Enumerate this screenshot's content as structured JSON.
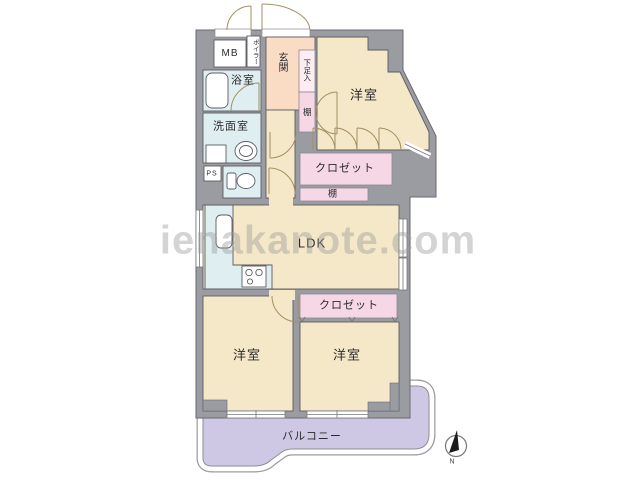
{
  "watermark": "ienakanote.com",
  "compass": {
    "north_label": "N"
  },
  "rooms": {
    "mb": "MB",
    "boiler": "ボイラー",
    "genkan": "玄関",
    "shoe_cabinet": "下足入",
    "shelf_entry": "棚",
    "bathroom": "浴室",
    "washroom": "洗面室",
    "ps": "PS",
    "bedroom_top": "洋室",
    "closet_top": "クロゼット",
    "shelf_mid": "棚",
    "ldk": "LDK",
    "closet_bottom": "クロゼット",
    "bedroom_left": "洋室",
    "bedroom_right": "洋室",
    "balcony": "バルコニー"
  },
  "colors": {
    "wall": "#9b9ba2",
    "room": "#f5e8c8",
    "entry": "#fadcc4",
    "closet": "#f6d7e6",
    "closet_light": "#fcedf3",
    "wet_area": "#dfeef1",
    "balcony": "#cfc8e4",
    "fixture": "#ffffff",
    "door_arc": "#a38f63"
  }
}
